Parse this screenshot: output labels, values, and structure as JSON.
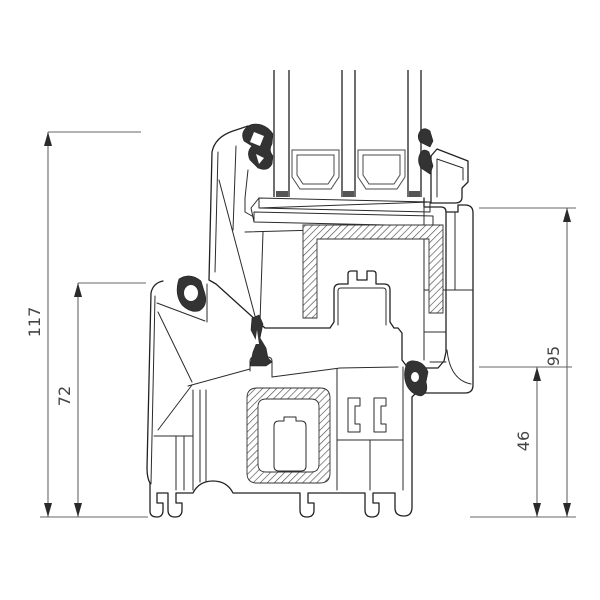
{
  "drawing": {
    "kind": "window-profile-cross-section",
    "dims": {
      "overall": "117",
      "frame_outer": "72",
      "frame_inner": "95",
      "rebate": "46"
    },
    "colors": {
      "background": "#ffffff",
      "profile_line": "#222222",
      "dimension_line": "#666666",
      "dimension_text": "#444444",
      "gasket_fill": "#333333",
      "glass_line": "#6e6e6e"
    }
  }
}
